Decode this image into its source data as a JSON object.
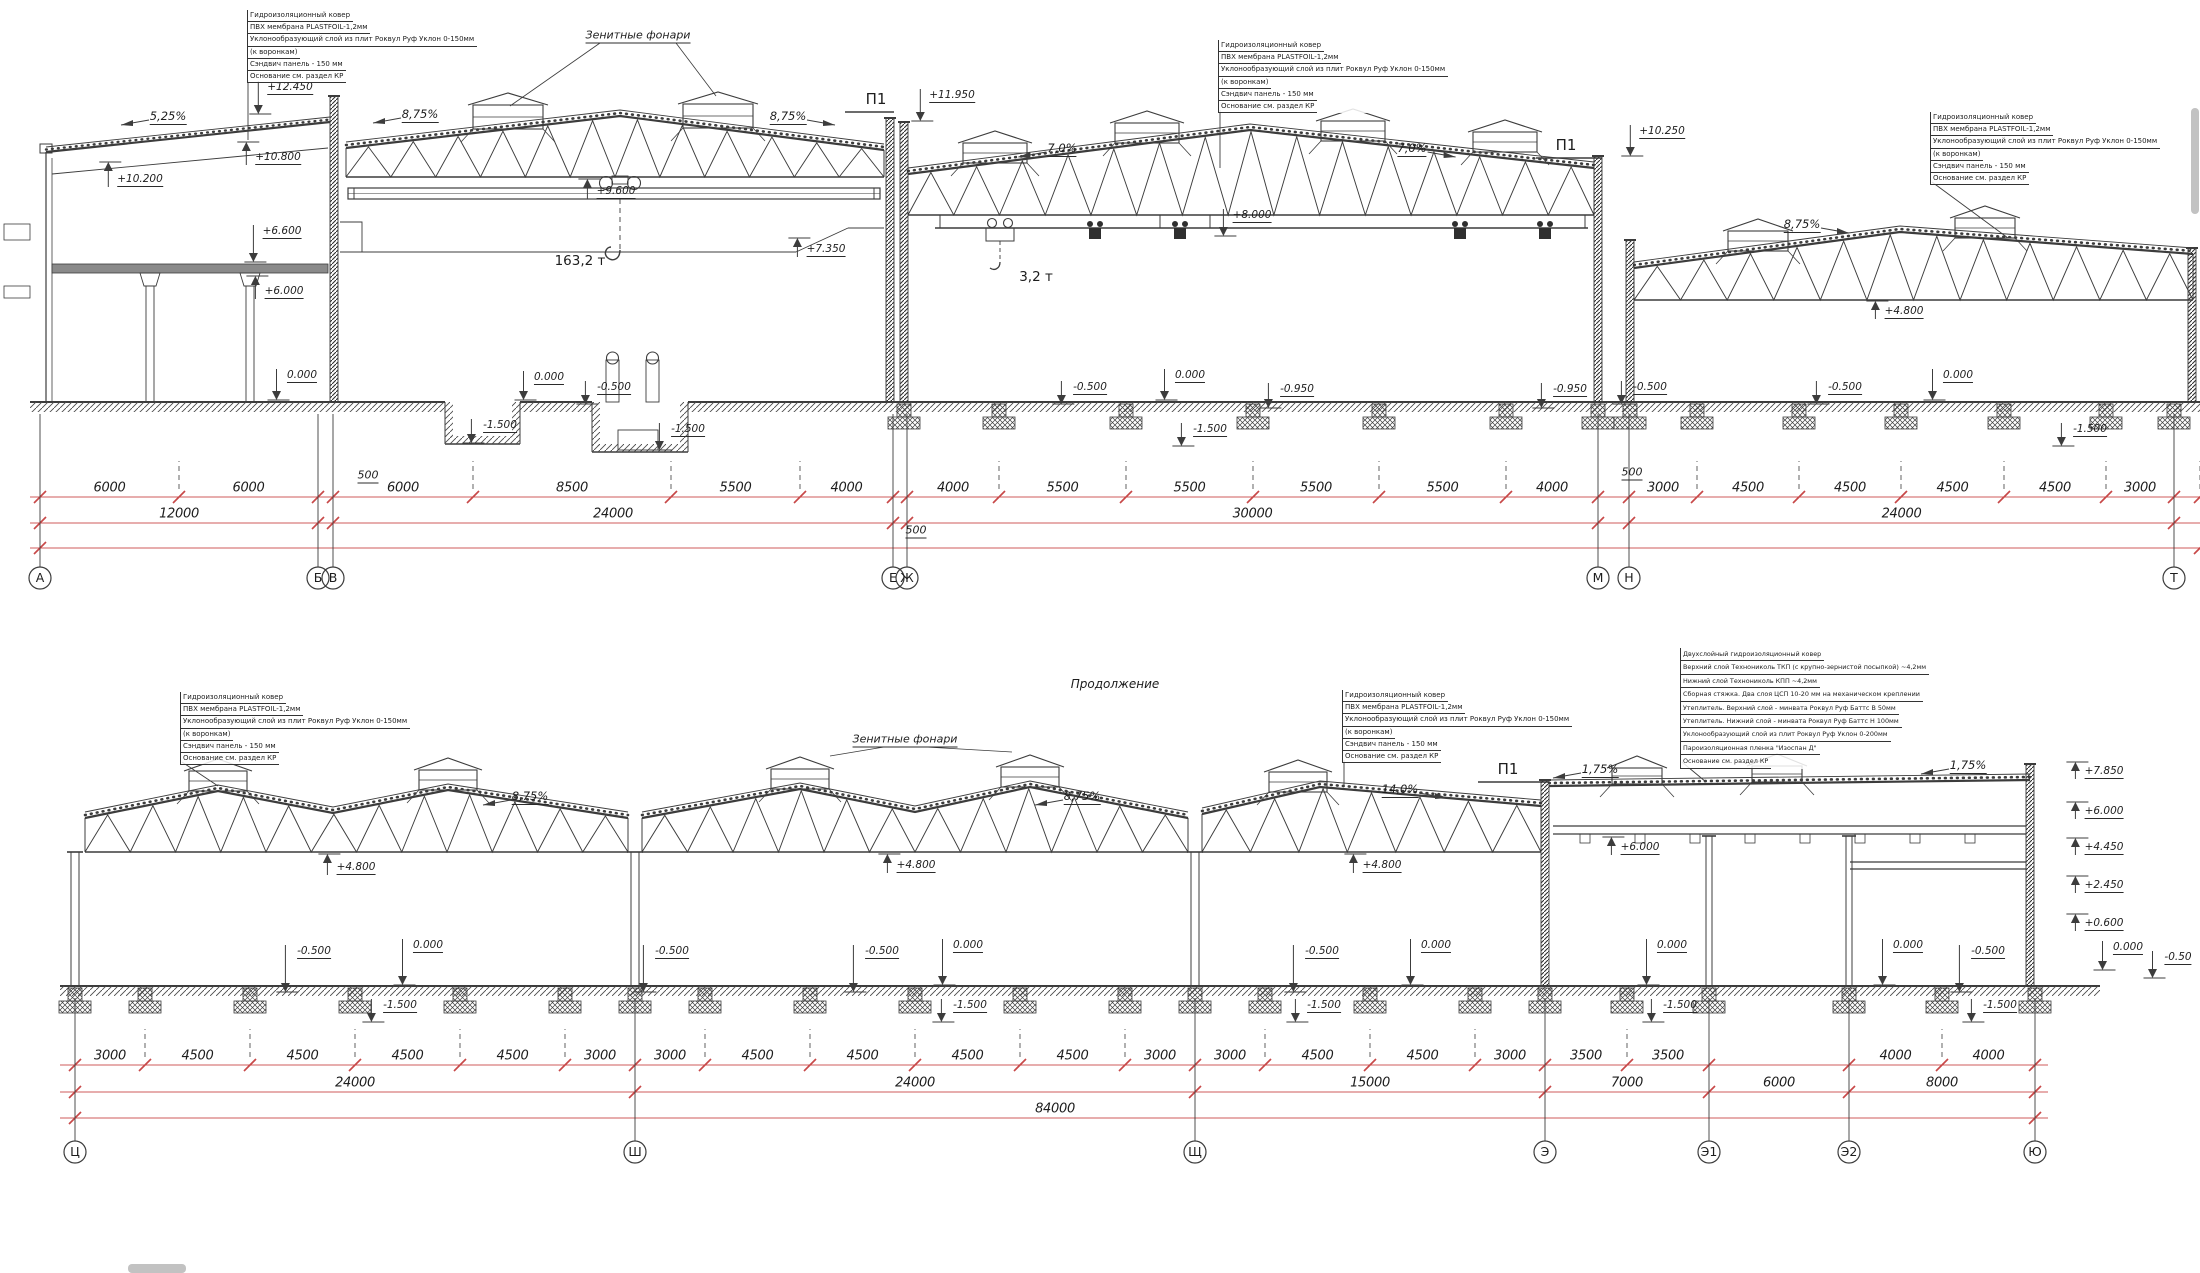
{
  "colors": {
    "line": "#3c3c3c",
    "red": "#cf5b5b",
    "red_tick": "#c84848",
    "text": "#1d1d1d",
    "scrollbar": "#c2c2c2"
  },
  "labels": {
    "p1": "П1",
    "skylights": "Зенитные фонари",
    "continuation": "Продолжение",
    "crane_main": "163,2 т",
    "crane_hoist": "3,2 т"
  },
  "callout_standard": [
    "Гидроизоляционный ковер",
    "ПВХ мембрана PLASTFOIL-1,2мм",
    "Уклонообразующий слой из плит Роквул Руф Уклон 0-150мм",
    "(к воронкам)",
    "Сэндвич панель - 150 мм",
    "Основание см. раздел КР"
  ],
  "callout_layered": [
    "Двухслойный гидроизоляционный ковер",
    "Верхний слой Технониколь ТКП (с крупно-зернистой посыпкой) ~4,2мм",
    "Нижний слой Технониколь КПП ~4,2мм",
    "Сборная стяжка. Два слоя ЦСП 10-20 мм на механическом креплении",
    "Утеплитель. Верхний слой - минвата Роквул Руф Баттс В 50мм",
    "Утеплитель. Нижний слой - минвата Роквул Руф Баттс Н 100мм",
    "Уклонообразующий слой из плит Роквул Руф Уклон 0-200мм",
    "Пароизоляционная пленка \"Изоспан Д\"",
    "Основание см. раздел КР"
  ],
  "p1_positions": [
    {
      "x": 876,
      "y": 99
    },
    {
      "x": 1566,
      "y": 145
    },
    {
      "x": 1508,
      "y": 769
    }
  ],
  "top": {
    "bubble_y": 578,
    "axes": [
      {
        "l": "А",
        "x": 40
      },
      {
        "l": "Б",
        "x": 318
      },
      {
        "l": "В",
        "x": 333
      },
      {
        "l": "Е",
        "x": 893
      },
      {
        "l": "Ж",
        "x": 907
      },
      {
        "l": "М",
        "x": 1598
      },
      {
        "l": "Н",
        "x": 1629
      },
      {
        "l": "Т",
        "x": 2174
      }
    ],
    "row_ext": [
      30,
      2200
    ],
    "dim_rows": [
      {
        "y": 497,
        "segs": [
          [
            40,
            179,
            "6000"
          ],
          [
            179,
            318,
            "6000"
          ],
          [
            318,
            333,
            ""
          ],
          [
            333,
            473,
            "6000"
          ],
          [
            473,
            671,
            "8500"
          ],
          [
            671,
            800,
            "5500"
          ],
          [
            800,
            893,
            "4000"
          ],
          [
            893,
            907,
            ""
          ],
          [
            907,
            999,
            "4000"
          ],
          [
            999,
            1126,
            "5500"
          ],
          [
            1126,
            1253,
            "5500"
          ],
          [
            1253,
            1379,
            "5500"
          ],
          [
            1379,
            1506,
            "5500"
          ],
          [
            1506,
            1598,
            "4000"
          ],
          [
            1598,
            1629,
            ""
          ],
          [
            1629,
            1697,
            "3000"
          ],
          [
            1697,
            1799,
            "4500"
          ],
          [
            1799,
            1901,
            "4500"
          ],
          [
            1901,
            2004,
            "4500"
          ],
          [
            2004,
            2106,
            "4500"
          ],
          [
            2106,
            2174,
            "3000"
          ],
          [
            2174,
            2200,
            ""
          ]
        ]
      },
      {
        "y": 523,
        "segs": [
          [
            40,
            318,
            "12000"
          ],
          [
            333,
            893,
            "24000"
          ],
          [
            907,
            1598,
            "30000"
          ],
          [
            1629,
            2174,
            "24000"
          ]
        ]
      },
      {
        "y": 548,
        "segs": [
          [
            40,
            2200,
            ""
          ]
        ]
      }
    ],
    "small_dims": [
      {
        "t": "500",
        "x": 368,
        "y": 476
      },
      {
        "t": "500",
        "x": 916,
        "y": 531
      },
      {
        "t": "500",
        "x": 1632,
        "y": 473
      }
    ],
    "elevations": [
      {
        "v": "+12.450",
        "x": 290,
        "y": 88,
        "d": "down",
        "ay": 114
      },
      {
        "v": "+10.200",
        "x": 140,
        "y": 180,
        "d": "up",
        "ay": 162
      },
      {
        "v": "+10.800",
        "x": 278,
        "y": 158,
        "d": "up",
        "ay": 142
      },
      {
        "v": "+6.600",
        "x": 282,
        "y": 232,
        "d": "down",
        "ay": 262
      },
      {
        "v": "+6.000",
        "x": 284,
        "y": 292,
        "d": "up",
        "ay": 276
      },
      {
        "v": "+9.600",
        "x": 616,
        "y": 192,
        "d": "up",
        "ay": 179
      },
      {
        "v": "+7.350",
        "x": 826,
        "y": 250,
        "d": "up",
        "ay": 238
      },
      {
        "v": "+11.950",
        "x": 952,
        "y": 96,
        "d": "down",
        "ay": 121
      },
      {
        "v": "+8.000",
        "x": 1252,
        "y": 216,
        "d": "down",
        "ay": 236
      },
      {
        "v": "+10.250",
        "x": 1662,
        "y": 132,
        "d": "down",
        "ay": 156
      },
      {
        "v": "+4.800",
        "x": 1904,
        "y": 312,
        "d": "up",
        "ay": 301
      },
      {
        "v": "0.000",
        "x": 302,
        "y": 376,
        "d": "down",
        "ay": 400
      },
      {
        "v": "0.000",
        "x": 549,
        "y": 378,
        "d": "down",
        "ay": 400
      },
      {
        "v": "-0.500",
        "x": 614,
        "y": 388,
        "d": "down",
        "ay": 404
      },
      {
        "v": "-1.500",
        "x": 500,
        "y": 426,
        "d": "down",
        "ay": 443
      },
      {
        "v": "-1.500",
        "x": 688,
        "y": 430,
        "d": "down",
        "ay": 450
      },
      {
        "v": "-0.500",
        "x": 1090,
        "y": 388,
        "d": "down",
        "ay": 404
      },
      {
        "v": "0.000",
        "x": 1190,
        "y": 376,
        "d": "down",
        "ay": 400
      },
      {
        "v": "-0.950",
        "x": 1297,
        "y": 390,
        "d": "down",
        "ay": 408
      },
      {
        "v": "-1.500",
        "x": 1210,
        "y": 430,
        "d": "down",
        "ay": 446
      },
      {
        "v": "-0.950",
        "x": 1570,
        "y": 390,
        "d": "down",
        "ay": 408
      },
      {
        "v": "-0.500",
        "x": 1650,
        "y": 388,
        "d": "down",
        "ay": 404
      },
      {
        "v": "-0.500",
        "x": 1845,
        "y": 388,
        "d": "down",
        "ay": 404
      },
      {
        "v": "0.000",
        "x": 1958,
        "y": 376,
        "d": "down",
        "ay": 400
      },
      {
        "v": "-1.500",
        "x": 2090,
        "y": 430,
        "d": "down",
        "ay": 446
      }
    ],
    "slopes": [
      {
        "v": "5,25%",
        "x": 168,
        "y": 117,
        "a": "left"
      },
      {
        "v": "8,75%",
        "x": 420,
        "y": 115,
        "a": "left"
      },
      {
        "v": "8,75%",
        "x": 788,
        "y": 117,
        "a": "right"
      },
      {
        "v": "7,0%",
        "x": 1062,
        "y": 149,
        "a": "left"
      },
      {
        "v": "7,0%",
        "x": 1412,
        "y": 149,
        "a": "right"
      },
      {
        "v": "8,75%",
        "x": 1802,
        "y": 225,
        "a": "right"
      }
    ],
    "callouts": [
      {
        "x": 247,
        "y": 10,
        "type": "standard",
        "leader": [
          248,
          80,
          248,
          140
        ]
      },
      {
        "x": 1218,
        "y": 40,
        "type": "standard",
        "leader": [
          1220,
          110,
          1220,
          168
        ]
      },
      {
        "x": 1930,
        "y": 112,
        "type": "standard",
        "leader": [
          1932,
          182,
          2008,
          238
        ]
      }
    ]
  },
  "bottom": {
    "bubble_y": 1152,
    "axes": [
      {
        "l": "Ц",
        "x": 75
      },
      {
        "l": "Ш",
        "x": 635
      },
      {
        "l": "Щ",
        "x": 1195
      },
      {
        "l": "Э",
        "x": 1545
      },
      {
        "l": "Э1",
        "x": 1709
      },
      {
        "l": "Э2",
        "x": 1849
      },
      {
        "l": "Ю",
        "x": 2035
      }
    ],
    "row_ext": [
      60,
      2048
    ],
    "dim_rows": [
      {
        "y": 1065,
        "segs": [
          [
            75,
            145,
            "3000"
          ],
          [
            145,
            250,
            "4500"
          ],
          [
            250,
            355,
            "4500"
          ],
          [
            355,
            460,
            "4500"
          ],
          [
            460,
            565,
            "4500"
          ],
          [
            565,
            635,
            "3000"
          ],
          [
            635,
            705,
            "3000"
          ],
          [
            705,
            810,
            "4500"
          ],
          [
            810,
            915,
            "4500"
          ],
          [
            915,
            1020,
            "4500"
          ],
          [
            1020,
            1125,
            "4500"
          ],
          [
            1125,
            1195,
            "3000"
          ],
          [
            1195,
            1265,
            "3000"
          ],
          [
            1265,
            1370,
            "4500"
          ],
          [
            1370,
            1475,
            "4500"
          ],
          [
            1475,
            1545,
            "3000"
          ],
          [
            1545,
            1627,
            "3500"
          ],
          [
            1627,
            1709,
            "3500"
          ],
          [
            1849,
            1942,
            "4000"
          ],
          [
            1942,
            2035,
            "4000"
          ]
        ]
      },
      {
        "y": 1092,
        "segs": [
          [
            75,
            635,
            "24000"
          ],
          [
            635,
            1195,
            "24000"
          ],
          [
            1195,
            1545,
            "15000"
          ],
          [
            1545,
            1709,
            "7000"
          ],
          [
            1709,
            1849,
            "6000"
          ],
          [
            1849,
            2035,
            "8000"
          ]
        ]
      },
      {
        "y": 1118,
        "segs": [
          [
            75,
            2035,
            "84000"
          ]
        ]
      }
    ],
    "small_dims": [],
    "elevations": [
      {
        "v": "+4.800",
        "x": 356,
        "y": 868,
        "d": "up",
        "ay": 854
      },
      {
        "v": "+4.800",
        "x": 916,
        "y": 866,
        "d": "up",
        "ay": 854
      },
      {
        "v": "+4.800",
        "x": 1382,
        "y": 866,
        "d": "up",
        "ay": 854
      },
      {
        "v": "+6.000",
        "x": 1640,
        "y": 848,
        "d": "up",
        "ay": 837
      },
      {
        "v": "+7.850",
        "x": 2104,
        "y": 772,
        "d": "up",
        "ay": 762
      },
      {
        "v": "+6.000",
        "x": 2104,
        "y": 812,
        "d": "up",
        "ay": 802
      },
      {
        "v": "+4.450",
        "x": 2104,
        "y": 848,
        "d": "up",
        "ay": 838
      },
      {
        "v": "+2.450",
        "x": 2104,
        "y": 886,
        "d": "up",
        "ay": 876
      },
      {
        "v": "+0.600",
        "x": 2104,
        "y": 924,
        "d": "up",
        "ay": 914
      },
      {
        "v": "0.000",
        "x": 2128,
        "y": 948,
        "d": "down",
        "ay": 970
      },
      {
        "v": "-0.50",
        "x": 2178,
        "y": 958,
        "d": "down",
        "ay": 978
      },
      {
        "v": "-0.500",
        "x": 314,
        "y": 952,
        "d": "down",
        "ay": 992
      },
      {
        "v": "0.000",
        "x": 428,
        "y": 946,
        "d": "down",
        "ay": 985
      },
      {
        "v": "-0.500",
        "x": 672,
        "y": 952,
        "d": "down",
        "ay": 992
      },
      {
        "v": "-0.500",
        "x": 882,
        "y": 952,
        "d": "down",
        "ay": 992
      },
      {
        "v": "0.000",
        "x": 968,
        "y": 946,
        "d": "down",
        "ay": 985
      },
      {
        "v": "-0.500",
        "x": 1322,
        "y": 952,
        "d": "down",
        "ay": 992
      },
      {
        "v": "0.000",
        "x": 1436,
        "y": 946,
        "d": "down",
        "ay": 985
      },
      {
        "v": "0.000",
        "x": 1672,
        "y": 946,
        "d": "down",
        "ay": 985
      },
      {
        "v": "0.000",
        "x": 1908,
        "y": 946,
        "d": "down",
        "ay": 985
      },
      {
        "v": "-0.500",
        "x": 1988,
        "y": 952,
        "d": "down",
        "ay": 992
      },
      {
        "v": "-1.500",
        "x": 400,
        "y": 1006,
        "d": "down",
        "ay": 1022
      },
      {
        "v": "-1.500",
        "x": 970,
        "y": 1006,
        "d": "down",
        "ay": 1022
      },
      {
        "v": "-1.500",
        "x": 1324,
        "y": 1006,
        "d": "down",
        "ay": 1022
      },
      {
        "v": "-1.500",
        "x": 1680,
        "y": 1006,
        "d": "down",
        "ay": 1022
      },
      {
        "v": "-1.500",
        "x": 2000,
        "y": 1006,
        "d": "down",
        "ay": 1022
      }
    ],
    "slopes": [
      {
        "v": "8,75%",
        "x": 530,
        "y": 797,
        "a": "left"
      },
      {
        "v": "8,75%",
        "x": 1082,
        "y": 797,
        "a": "left"
      },
      {
        "v": "14,0%",
        "x": 1400,
        "y": 790,
        "a": "right"
      },
      {
        "v": "1,75%",
        "x": 1600,
        "y": 770,
        "a": "left"
      },
      {
        "v": "1,75%",
        "x": 1968,
        "y": 766,
        "a": "left"
      }
    ],
    "callouts": [
      {
        "x": 180,
        "y": 692,
        "type": "standard",
        "leader": [
          182,
          762,
          218,
          786
        ]
      },
      {
        "x": 1342,
        "y": 690,
        "type": "standard",
        "leader": [
          1344,
          760,
          1344,
          786
        ]
      },
      {
        "x": 1680,
        "y": 648,
        "type": "layered",
        "leader": [
          1682,
          762,
          1706,
          782
        ]
      }
    ]
  }
}
